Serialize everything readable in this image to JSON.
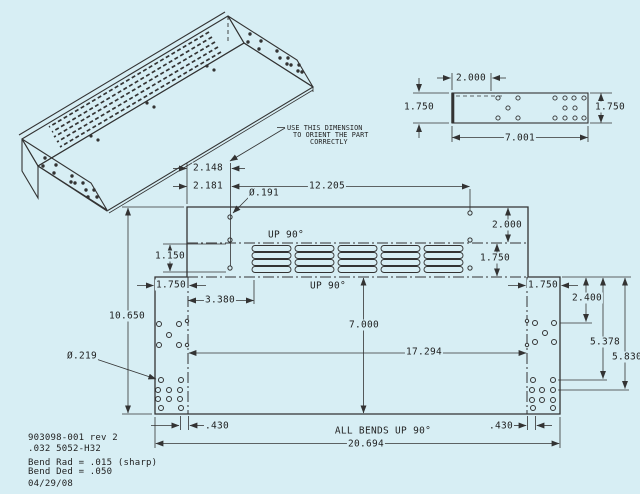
{
  "drawing": {
    "background_color": "#d7eef4",
    "line_color": "#333333",
    "orient_note": {
      "line1": "USE THIS DIMENSION",
      "line2": "TO ORIENT THE PART",
      "line3": "CORRECTLY"
    },
    "detail_view": {
      "dim_width_top": "2.000",
      "dim_height_left": "1.750",
      "dim_height_right": "1.750",
      "dim_width_bottom": "7.001"
    },
    "flat_pattern": {
      "dim_edge_to_hole_a": "2.148",
      "dim_edge_to_hole_b": "2.181",
      "dim_hole_span": "12.205",
      "hole_callout_small": "Ø.191",
      "dim_top_flange": "2.000",
      "dim_louver_strip": "1.750",
      "dim_louver_holes": "1.150",
      "bend_note_top": "UP 90°",
      "bend_note_bottom": "UP 90°",
      "dim_left_flap": "1.750",
      "dim_right_flap": "1.750",
      "dim_louver_offset": "3.380",
      "dim_overall_height": "10.650",
      "hole_callout_large": "Ø.219",
      "dim_panel_height": "7.000",
      "dim_bend_span": "17.294",
      "dim_hole_row_a": "2.400",
      "dim_hole_row_b": "5.378",
      "dim_hole_row_c": "5.830",
      "dim_hole_offset_left": ".430",
      "dim_hole_offset_right": ".430",
      "all_bends_note": "ALL BENDS UP 90°",
      "dim_overall_width": "20.694"
    },
    "title_block": {
      "part_number": "903098-001 rev 2",
      "material": ".032 5052-H32",
      "bend_rad": "Bend Rad = .015 (sharp)",
      "bend_ded": "Bend Ded = .050",
      "date": "04/29/08"
    }
  }
}
